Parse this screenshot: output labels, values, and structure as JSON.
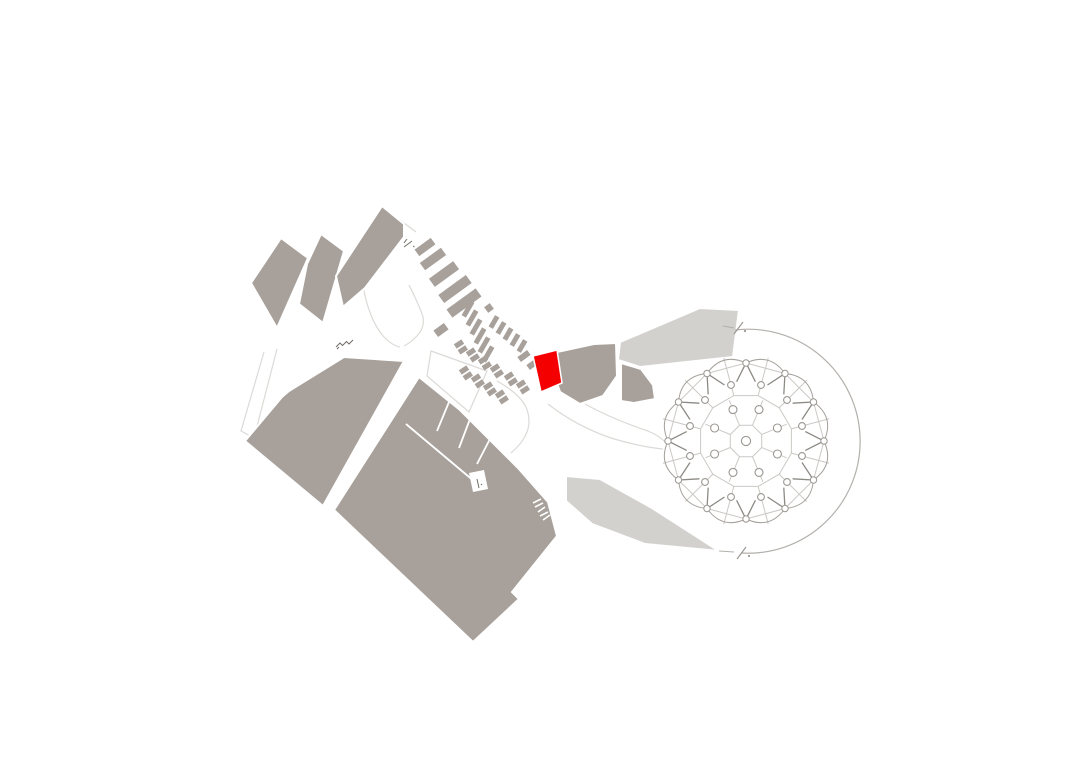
{
  "canvas": {
    "width": 1080,
    "height": 764,
    "background": "#ffffff"
  },
  "colors": {
    "mass": "#a8a19b",
    "light": "#d3d1ce",
    "highlight": "#f40000",
    "outline": "#dcdad7",
    "ring": "#b3b0ac",
    "dome_line": "#cbc9c5",
    "dome_dark": "#8d8a85",
    "knob_stroke": "#9b9792",
    "detail": "#716d67",
    "white": "#ffffff"
  },
  "faint_paths": [
    {
      "name": "promenade-funnel-left",
      "d": "M363,286 Q369,320 384,337 Q393,346 400,347"
    },
    {
      "name": "promenade-funnel-right",
      "d": "M409,285 Q420,307 423,317 Q425,328 416,337 Q410,343 404,346"
    },
    {
      "name": "promenade-plaza-quad",
      "d": "M431,351 L487,371 L469,412 L427,376 Z"
    },
    {
      "name": "west-walkway",
      "d": "M264,352 L241,431 L254,438 L277,349"
    },
    {
      "name": "dome-approach-upper",
      "d": "M585,404 Q612,419 648,431 Q660,436 666,443"
    },
    {
      "name": "dome-approach-lower",
      "d": "M548,404 Q576,426 611,438 Q641,447 663,449"
    },
    {
      "name": "south-walkway",
      "d": "M509,461 Q529,492 547,519"
    },
    {
      "name": "promenade-east-edge",
      "d": "M497,381 Q517,392 525,405 Q531,417 528,429 Q524,442 511,453"
    },
    {
      "name": "north-entrance-edge",
      "d": "M400,220 L416,232"
    }
  ],
  "masses": [
    {
      "name": "block-northwest-1",
      "tone": "mass",
      "points": "251,283 281,238 308,258 277,328"
    },
    {
      "name": "block-northwest-2",
      "tone": "mass",
      "points": "321,234 344,251 323,323 299,304 307,264"
    },
    {
      "name": "block-north",
      "tone": "mass",
      "points": "382,206 404,224 404,237 365,288 343,307 336,276"
    },
    {
      "name": "block-west",
      "tone": "mass",
      "points": "344,357 404,361 323,506 245,441 282,397 289,391"
    },
    {
      "name": "block-south",
      "tone": "mass",
      "points": "419,377 460,410 506,456 518,468 548,502 557,536 512,592 519,599 473,642 334,510"
    },
    {
      "name": "block-bend-west",
      "tone": "mass",
      "points": "557,352 594,344 616,343 617,376 603,396 580,404 560,392 553,372"
    },
    {
      "name": "block-bend-east",
      "tone": "mass",
      "points": "621,363 641,369 653,385 655,399 634,403 621,401"
    },
    {
      "name": "terrace-north",
      "tone": "light",
      "points": "620,342 700,308 739,310 733,357 640,367 618,360"
    },
    {
      "name": "terrace-south",
      "tone": "light",
      "points": "566,476 600,479 652,508 719,551 645,544 592,524 566,501"
    }
  ],
  "white_lines": [
    {
      "name": "room-divider",
      "pts": [
        406,
        424,
        481,
        487
      ],
      "w": 1.8
    },
    {
      "name": "room-divider",
      "pts": [
        449,
        402,
        437,
        431
      ],
      "w": 1.8
    },
    {
      "name": "room-divider",
      "pts": [
        470,
        419,
        459,
        448
      ],
      "w": 1.8
    },
    {
      "name": "room-divider",
      "pts": [
        491,
        437,
        477,
        464
      ],
      "w": 1.8
    },
    {
      "name": "stair-tooth",
      "pts": [
        533,
        503,
        541,
        499
      ],
      "w": 1.6
    },
    {
      "name": "stair-tooth",
      "pts": [
        535,
        507,
        543,
        503
      ],
      "w": 1.6
    },
    {
      "name": "stair-tooth",
      "pts": [
        538,
        512,
        545,
        507
      ],
      "w": 1.6
    },
    {
      "name": "stair-tooth",
      "pts": [
        540,
        516,
        548,
        512
      ],
      "w": 1.6
    },
    {
      "name": "stair-tooth",
      "pts": [
        543,
        520,
        550,
        515
      ],
      "w": 1.6
    }
  ],
  "white_polys": [
    {
      "name": "service-notch",
      "points": "469,473 484,470 488,489 473,492"
    }
  ],
  "stripe_groups": [
    {
      "name": "shop-row-north",
      "angle": -36,
      "rects": [
        [
          425,
          247,
          20,
          8
        ],
        [
          433,
          259,
          26,
          9
        ],
        [
          444,
          274,
          30,
          10
        ],
        [
          455,
          289,
          34,
          10
        ],
        [
          464,
          303,
          36,
          10
        ]
      ]
    },
    {
      "name": "shop-row-columns",
      "angle": -60,
      "rects": [
        [
          468,
          309,
          17,
          5
        ],
        [
          472,
          318,
          17,
          5
        ],
        [
          476,
          327,
          17,
          5
        ],
        [
          480,
          336,
          17,
          5
        ],
        [
          484,
          345,
          17,
          5
        ],
        [
          488,
          354,
          17,
          5
        ]
      ]
    },
    {
      "name": "shop-row-mid",
      "angle": -60,
      "rects": [
        [
          494,
          322,
          13,
          5
        ],
        [
          501,
          328,
          13,
          5
        ],
        [
          508,
          334,
          13,
          5
        ],
        [
          515,
          340,
          13,
          5
        ],
        [
          522,
          346,
          13,
          5
        ]
      ]
    },
    {
      "name": "shop-pair-east",
      "angle": -36,
      "rects": [
        [
          524,
          356,
          12,
          6
        ],
        [
          533,
          364,
          12,
          6
        ]
      ]
    },
    {
      "name": "kiosk-single",
      "angle": -36,
      "rects": [
        [
          489,
          308,
          7,
          7
        ],
        [
          441,
          330,
          13,
          8
        ]
      ]
    }
  ],
  "stall_clusters": {
    "name": "market-stall-cluster",
    "angle": -33,
    "rect_w": 9,
    "rect_h": 5.2,
    "pair_dx": 3.8,
    "pair_dy": 5.9,
    "centers": [
      [
        459,
        344
      ],
      [
        471,
        352
      ],
      [
        483,
        360
      ],
      [
        495,
        368
      ],
      [
        464,
        370
      ],
      [
        476,
        378
      ],
      [
        488,
        386
      ],
      [
        500,
        394
      ],
      [
        509,
        376
      ],
      [
        521,
        384
      ]
    ]
  },
  "highlight_unit": {
    "name": "highlighted-unit",
    "points": "533,356 557,350 562,383 541,392"
  },
  "ring": {
    "name": "ring-walkway",
    "arc": "M735,330 A112,112 0 1 1 741,553",
    "breaks": [
      {
        "name": "break-mark-north",
        "dash": [
          723,
          326,
          734,
          328
        ],
        "slash": [
          734,
          334,
          743,
          322
        ],
        "dot": [
          745,
          331
        ]
      },
      {
        "name": "break-mark-south",
        "dash": [
          719,
          551,
          734,
          552
        ],
        "slash": [
          737,
          559,
          746,
          547
        ],
        "dot": [
          749,
          556
        ]
      }
    ]
  },
  "dome": {
    "name": "dome-pavilion",
    "cx": 746,
    "cy": 441,
    "segments": 12,
    "r_vertex": 78,
    "r_bulge": 92,
    "r_spike": 60,
    "spike_spread": 9,
    "knob_r": 3.2,
    "center_r": 4.6,
    "web": {
      "poly8_r": 17,
      "poly8_rot": 22.5,
      "poly12_r": 47,
      "poly12_rot": 15,
      "radial8_out": 44,
      "radial12_out": 86
    },
    "circle_rings": [
      {
        "count": 8,
        "r": 34,
        "cr": 4.0,
        "rot": 22.5
      },
      {
        "count": 12,
        "r": 58,
        "cr": 3.4,
        "rot": 15
      }
    ]
  },
  "icons": [
    {
      "name": "stairs-icon",
      "d": "M336,347 l4,-4 l2.5,2.5 l4,-4 l2.5,2.5 l4,-4 M337,349 l2,-2"
    },
    {
      "name": "entrance-mark-icon",
      "d": "M404,247 l8,-6 M407,239 l-3,4 M413,246 l1.5,1"
    },
    {
      "name": "door-mark-icon",
      "d": "M477,479 l2,9 M481,484 l1,1"
    }
  ]
}
